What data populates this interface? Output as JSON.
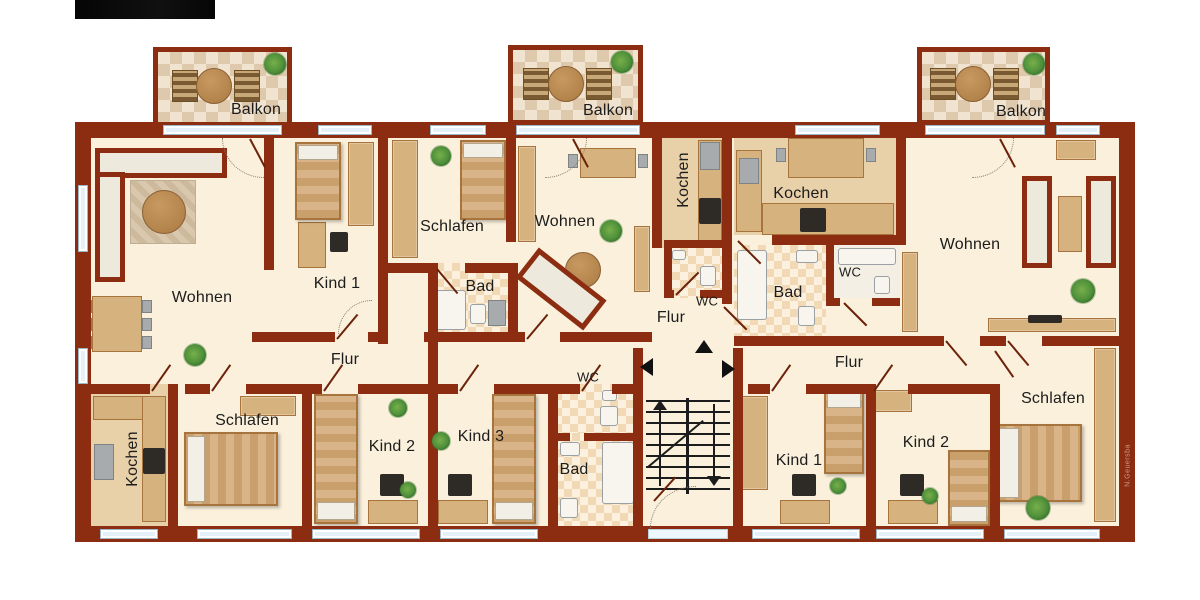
{
  "rooms": {
    "balkon_left": "Balkon",
    "balkon_middle": "Balkon",
    "balkon_right": "Balkon",
    "wohnen_left": "Wohnen",
    "kind1_left": "Kind 1",
    "flur_left": "Flur",
    "schlafen_middle": "Schlafen",
    "wohnen_middle": "Wohnen",
    "bad_middle": "Bad",
    "kochen_middle": "Kochen",
    "wc_middle": "WC",
    "flur_middle": "Flur",
    "wc_stairwell": "WC",
    "bad_lower": "Bad",
    "kochen_right": "Kochen",
    "bad_right": "Bad",
    "wc_right": "WC",
    "wohnen_right": "Wohnen",
    "flur_right": "Flur",
    "kochen_lower_left": "Kochen",
    "schlafen_lower_left": "Schlafen",
    "kind2_left": "Kind 2",
    "kind3_middle": "Kind 3",
    "kind1_right": "Kind 1",
    "kind2_right": "Kind 2",
    "schlafen_right": "Schlafen"
  },
  "watermark": "N.Geuersba",
  "colors": {
    "wall": "#8c2d11",
    "floor": "#faf0dc",
    "kitchen_floor": "#e8d0a9",
    "tile_light": "#f0e4d0",
    "tile_dark": "#dfc9ad",
    "window": "#e4f1f8",
    "wood": "#d6b27e",
    "plant": "#4e8f3a"
  }
}
